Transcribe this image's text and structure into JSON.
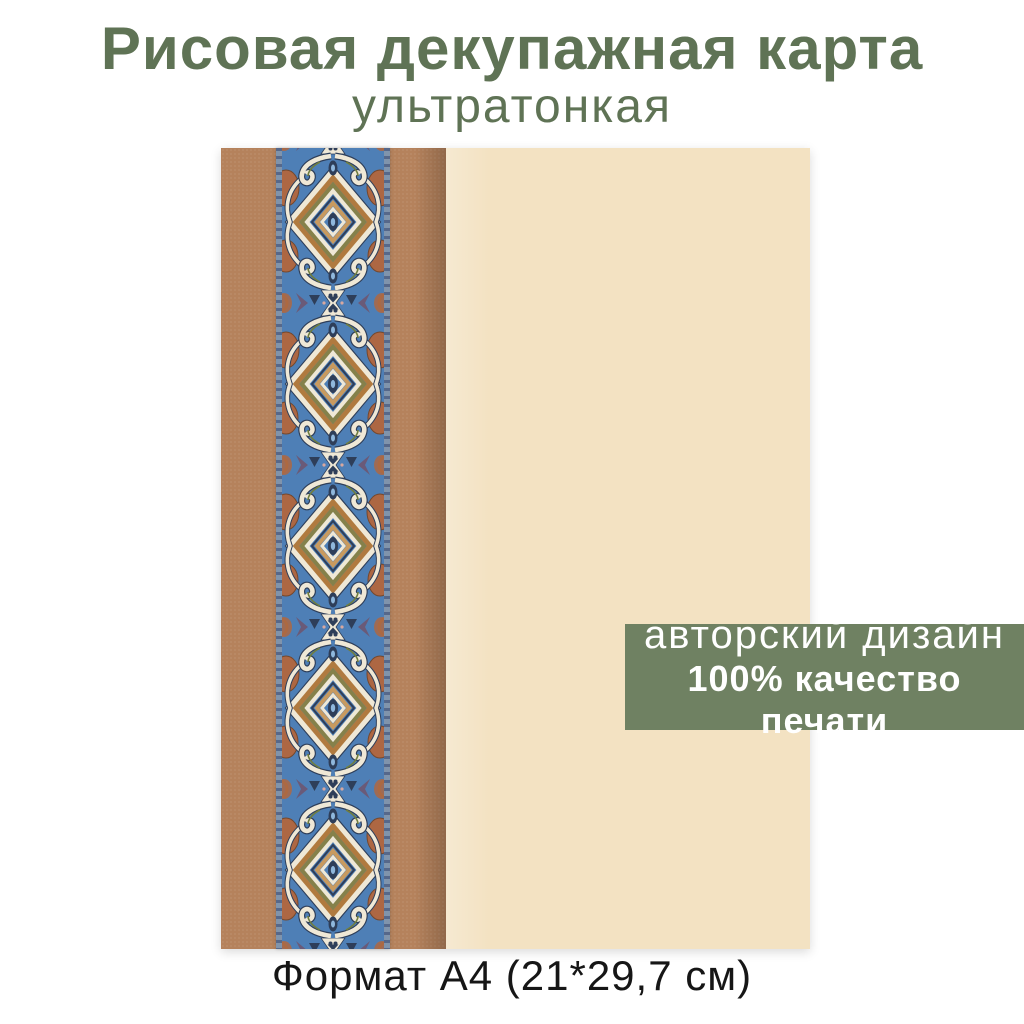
{
  "header": {
    "title": "Рисовая декупажная карта",
    "subtitle": "ультратонкая"
  },
  "badge": {
    "line1": "авторский дизайн",
    "line2": "100% качество печати"
  },
  "footer": {
    "format_label": "Формат А4 (21*29,7 см)"
  },
  "ornament": {
    "name": "art-nouveau-border-strip",
    "description_colors": [
      "#4e7fb6",
      "#2e3e59",
      "#efe8d6",
      "#ad6743",
      "#a9743f",
      "#85814a",
      "#6a5a78",
      "#8fb7dc"
    ]
  },
  "colors": {
    "background": "#ffffff",
    "title_green": "#5f7355",
    "badge_green": "#6f8162",
    "badge_text": "#ffffff",
    "paper_tan": "#b5825c",
    "paper_cream": "#f3e2c2",
    "caption_text": "#161616"
  }
}
